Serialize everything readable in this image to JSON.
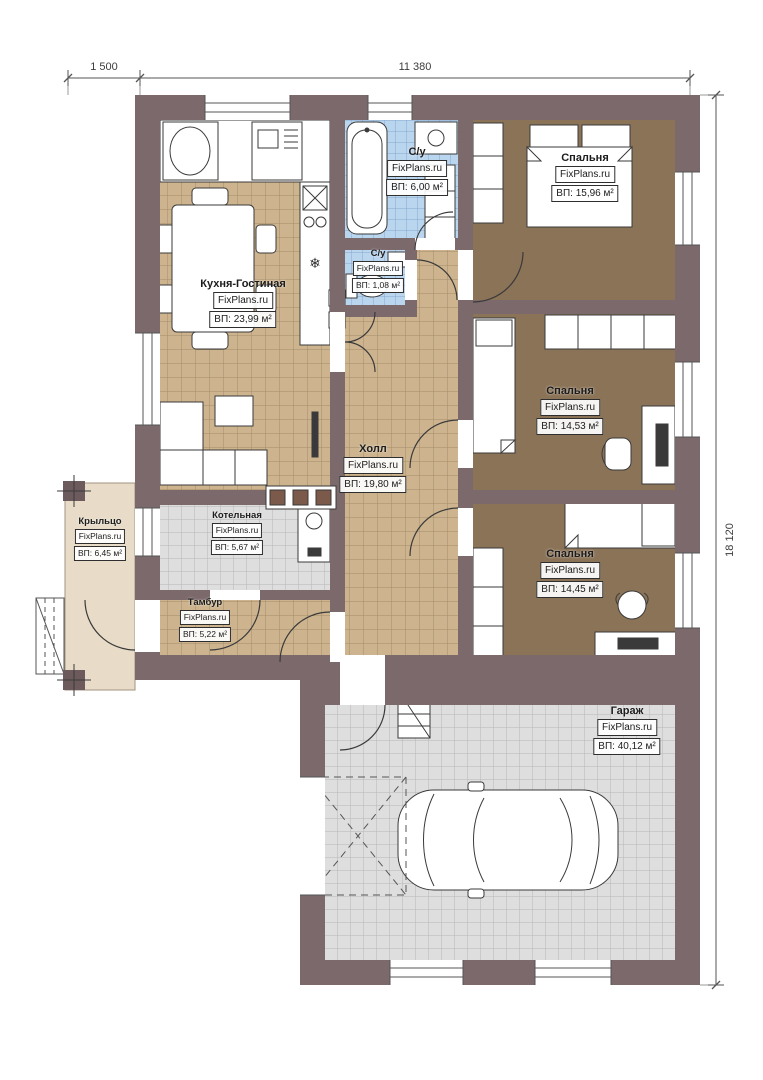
{
  "watermark": "FixPlans.ru",
  "dimensions": {
    "porch_width": "1 500",
    "house_width": "11 380",
    "house_height": "18 120"
  },
  "rooms": {
    "kitchen_living": {
      "name": "Кухня-Гостиная",
      "area": "ВП: 23,99 м²"
    },
    "bathroom": {
      "name": "С/у",
      "area": "ВП: 6,00 м²"
    },
    "wc": {
      "name": "С/у",
      "area": "ВП: 1,08 м²"
    },
    "bedroom_top": {
      "name": "Спальня",
      "area": "ВП: 15,96 м²"
    },
    "bedroom_middle": {
      "name": "Спальня",
      "area": "ВП: 14,53 м²"
    },
    "bedroom_bottom": {
      "name": "Спальня",
      "area": "ВП: 14,45 м²"
    },
    "hall": {
      "name": "Холл",
      "area": "ВП: 19,80 м²"
    },
    "boiler": {
      "name": "Котельная",
      "area": "ВП: 5,67 м²"
    },
    "vestibule": {
      "name": "Тамбур",
      "area": "ВП: 5,22 м²"
    },
    "porch": {
      "name": "Крыльцо",
      "area": "ВП: 6,45 м²"
    },
    "garage": {
      "name": "Гараж",
      "area": "ВП: 40,12 м²"
    }
  },
  "colors": {
    "wall": "#7c696c",
    "floor_wood": "#cdb48f",
    "floor_bedroom": "#8b7357",
    "floor_tile_blue": "#bad6ef",
    "floor_tile_gray": "#dedede",
    "porch_floor": "#e8dcc8"
  }
}
